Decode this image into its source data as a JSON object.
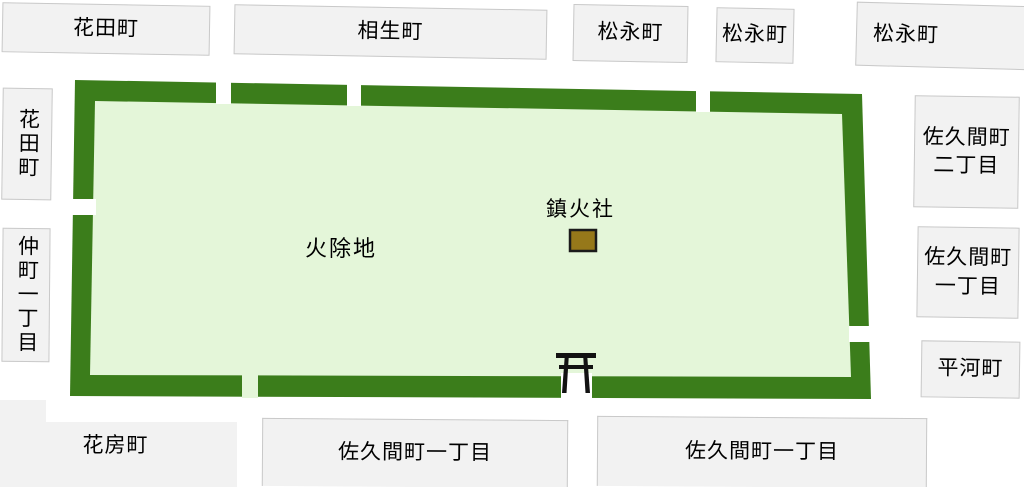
{
  "map": {
    "field": {
      "label": "火除地"
    },
    "shrine": {
      "label": "鎮火社"
    },
    "blocks": {
      "top": [
        "花田町",
        "相生町",
        "松永町",
        "松永町",
        "松永町"
      ],
      "left": [
        "花田町",
        "仲町一丁目"
      ],
      "right": [
        "佐久間町二丁目",
        "佐久間町一丁目",
        "平河町"
      ],
      "bottom": [
        "花房町",
        "佐久間町一丁目",
        "佐久間町一丁目"
      ]
    },
    "icons": {
      "torii": "torii-gate-icon",
      "shrine_marker": "shrine-marker"
    },
    "colors": {
      "embankment_green": "#3b7d1b",
      "field_green": "#e4f6d9",
      "marker_brown": "#96781a",
      "marker_outline": "#1b1b1b",
      "block_fill": "#f2f2f2",
      "block_border": "#c9c9c9",
      "road_white": "#ffffff"
    }
  }
}
